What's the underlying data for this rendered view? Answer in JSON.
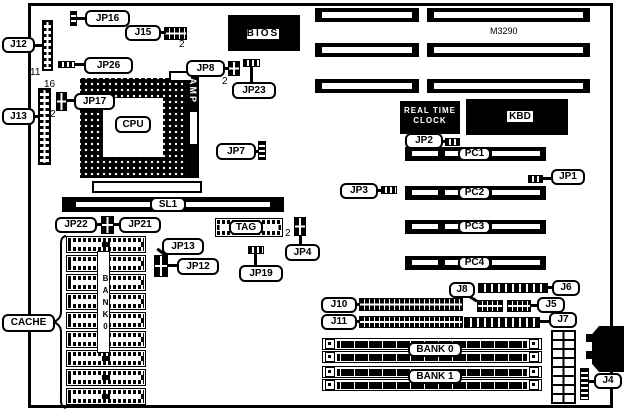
{
  "labels": {
    "j12": "J12",
    "jp16": "JP16",
    "j15": "J15",
    "jp26": "JP26",
    "j13": "J13",
    "jp17": "JP17",
    "jp8": "JP8",
    "jp23": "JP23",
    "bios": "BIOS",
    "m3290": "M3290",
    "cpu": "CPU",
    "amp": "AMP",
    "jp7": "JP7",
    "sl1": "SL1",
    "jp22": "JP22",
    "jp21": "JP21",
    "jp13": "JP13",
    "jp12": "JP12",
    "tag": "TAG",
    "jp4": "JP4",
    "jp19": "JP19",
    "cache": "CACHE",
    "cache_bank": "BANK0",
    "rtc_line1": "REAL TIME",
    "rtc_line2": "CLOCK",
    "kbd": "KBD",
    "jp2": "JP2",
    "jp1": "JP1",
    "jp3": "JP3",
    "pc1": "PC1",
    "pc2": "PC2",
    "pc3": "PC3",
    "pc4": "PC4",
    "j10": "J10",
    "j11": "J11",
    "j8": "J8",
    "j6": "J6",
    "j5": "J5",
    "j7": "J7",
    "j4": "J4",
    "bank0_simm": "BANK 0",
    "bank1_simm": "BANK 1"
  },
  "pin_numbers": {
    "j12_pins": "11",
    "j15_pin2": "2",
    "jp8_pin2": "2",
    "jp17_pin16": "16",
    "jp17_pin2": "2",
    "jp4_pin2": "2"
  }
}
